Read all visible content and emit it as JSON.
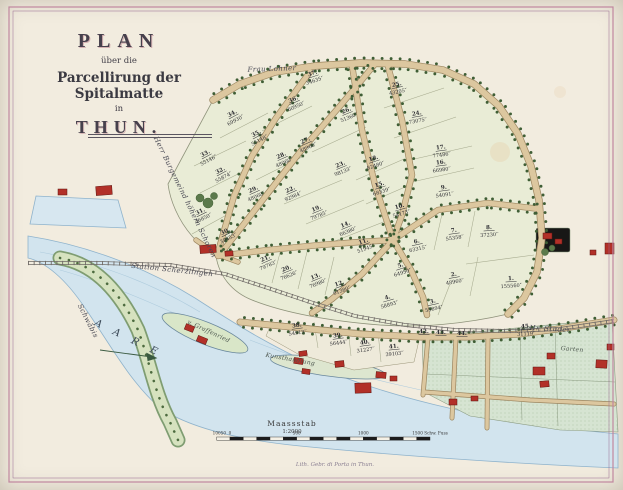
{
  "title": {
    "line1": "PLAN",
    "line2": "über die",
    "line3": "Parcellirung der Spitalmatte",
    "line4": "in",
    "line5": "THUN."
  },
  "labels": [
    {
      "id": "frau-lohner",
      "text": "Frau Lohner",
      "x": 272,
      "y": 71,
      "rot": -2,
      "cls": "cursive"
    },
    {
      "id": "owner-schoren",
      "text": "Herr Burgemeind höhern Schoren",
      "x": 183,
      "y": 198,
      "rot": 64,
      "cls": "cursive"
    },
    {
      "id": "station-scherzlingen",
      "text": "Station Scherzlingen",
      "x": 172,
      "y": 272,
      "rot": 6,
      "cls": "cursive"
    },
    {
      "id": "river-aare",
      "text": "A A R E",
      "x": 127,
      "y": 341,
      "rot": 26,
      "cls": "river"
    },
    {
      "id": "schwaebis",
      "text": "Schwäbis",
      "x": 86,
      "y": 322,
      "rot": 63,
      "cls": "cursive"
    },
    {
      "id": "graffenried",
      "text": "v. Graffenried",
      "x": 208,
      "y": 333,
      "rot": 25,
      "cls": "cursive-sm"
    },
    {
      "id": "kunsthandlung",
      "text": "Kunsthandlung",
      "x": 290,
      "y": 361,
      "rot": 10,
      "cls": "cursive-sm"
    },
    {
      "id": "hr-studer",
      "text": "Hr. Studer",
      "x": 550,
      "y": 331,
      "rot": 3,
      "cls": "cursive"
    },
    {
      "id": "garten",
      "text": "Garten",
      "x": 572,
      "y": 351,
      "rot": 5,
      "cls": "cursive-sm"
    }
  ],
  "area_suffix": "°′",
  "parcels": [
    {
      "n": "1.",
      "a": "155560",
      "x": 511,
      "y": 280,
      "r": -4
    },
    {
      "n": "2.",
      "a": "48960",
      "x": 454,
      "y": 276,
      "r": -10
    },
    {
      "n": "3.",
      "a": "55894",
      "x": 433,
      "y": 303,
      "r": -12
    },
    {
      "n": "4.",
      "a": "58893",
      "x": 388,
      "y": 299,
      "r": -16
    },
    {
      "n": "5.",
      "a": "64950",
      "x": 401,
      "y": 267,
      "r": -18
    },
    {
      "n": "6.",
      "a": "63315",
      "x": 417,
      "y": 243,
      "r": -12
    },
    {
      "n": "7.",
      "a": "55358",
      "x": 454,
      "y": 232,
      "r": -8
    },
    {
      "n": "8.",
      "a": "37230",
      "x": 489,
      "y": 229,
      "r": -4
    },
    {
      "n": "9.",
      "a": "54091",
      "x": 444,
      "y": 189,
      "r": -8
    },
    {
      "n": "10.",
      "a": "54173",
      "x": 400,
      "y": 208,
      "r": -16
    },
    {
      "n": "11.",
      "a": "51945",
      "x": 364,
      "y": 243,
      "r": -20
    },
    {
      "n": "12.",
      "a": "61380",
      "x": 340,
      "y": 285,
      "r": -20
    },
    {
      "n": "13.",
      "a": "76980",
      "x": 316,
      "y": 278,
      "r": -22
    },
    {
      "n": "14.",
      "a": "66380",
      "x": 346,
      "y": 226,
      "r": -22
    },
    {
      "n": "15.",
      "a": "68339",
      "x": 380,
      "y": 186,
      "r": -18
    },
    {
      "n": "16.",
      "a": "66980",
      "x": 441,
      "y": 164,
      "r": -8
    },
    {
      "n": "17.",
      "a": "77486",
      "x": 441,
      "y": 149,
      "r": -8
    },
    {
      "n": "18.",
      "a": "82480",
      "x": 374,
      "y": 160,
      "r": -18
    },
    {
      "n": "19.",
      "a": "79785",
      "x": 317,
      "y": 210,
      "r": -22
    },
    {
      "n": "20.",
      "a": "76626",
      "x": 287,
      "y": 270,
      "r": -22
    },
    {
      "n": "21.",
      "a": "79783",
      "x": 266,
      "y": 260,
      "r": -24
    },
    {
      "n": "22.",
      "a": "92984",
      "x": 291,
      "y": 191,
      "r": -24
    },
    {
      "n": "23.",
      "a": "98133",
      "x": 341,
      "y": 166,
      "r": -22
    },
    {
      "n": "24.",
      "a": "73075",
      "x": 417,
      "y": 115,
      "r": -10
    },
    {
      "n": "25.",
      "a": "43205",
      "x": 397,
      "y": 86,
      "r": -12
    },
    {
      "n": "26.",
      "a": "51360",
      "x": 347,
      "y": 112,
      "r": -22
    },
    {
      "n": "27.",
      "a": "48960",
      "x": 306,
      "y": 142,
      "r": -24
    },
    {
      "n": "28.",
      "a": "48060",
      "x": 282,
      "y": 157,
      "r": -24
    },
    {
      "n": "29.",
      "a": "48060",
      "x": 254,
      "y": 191,
      "r": -24
    },
    {
      "n": "30.",
      "a": "39453",
      "x": 226,
      "y": 233,
      "r": -26
    },
    {
      "n": "31.",
      "a": "46850",
      "x": 201,
      "y": 213,
      "r": -26
    },
    {
      "n": "32.",
      "a": "55874",
      "x": 221,
      "y": 172,
      "r": -28
    },
    {
      "n": "33.",
      "a": "55146",
      "x": 206,
      "y": 155,
      "r": -28
    },
    {
      "n": "34.",
      "a": "69930",
      "x": 233,
      "y": 115,
      "r": -28
    },
    {
      "n": "35.",
      "a": "55148",
      "x": 257,
      "y": 135,
      "r": -28
    },
    {
      "n": "36.",
      "a": "60950",
      "x": 294,
      "y": 101,
      "r": -24
    },
    {
      "n": "37.",
      "a": "34635",
      "x": 313,
      "y": 75,
      "r": -18
    },
    {
      "n": "38.",
      "a": "54913",
      "x": 297,
      "y": 327,
      "r": -8
    },
    {
      "n": "39.",
      "a": "56444",
      "x": 338,
      "y": 337,
      "r": -8
    },
    {
      "n": "40.",
      "a": "31227",
      "x": 365,
      "y": 344,
      "r": -8
    },
    {
      "n": "41.",
      "a": "39103",
      "x": 394,
      "y": 348,
      "r": -6
    },
    {
      "n": "42.",
      "a": "",
      "x": 424,
      "y": 333,
      "r": 0
    },
    {
      "n": "43.",
      "a": "",
      "x": 441,
      "y": 334,
      "r": 0
    },
    {
      "n": "44.",
      "a": "",
      "x": 462,
      "y": 335,
      "r": 0
    },
    {
      "n": "45.",
      "a": "31119",
      "x": 526,
      "y": 328,
      "r": -3
    }
  ],
  "scale": {
    "caption": "Maassstab",
    "ratio": "1:2000",
    "ticks": [
      {
        "v": -100,
        "t": "100"
      },
      {
        "v": -50,
        "t": "50"
      },
      {
        "v": 0,
        "t": "0"
      },
      {
        "v": 500,
        "t": "500"
      },
      {
        "v": 1000,
        "t": "1000"
      },
      {
        "v": 1500,
        "t": "1500 Schw. Fuss"
      }
    ]
  },
  "imprint": "Lith. Gebr. di Porta in Thun.",
  "colors": {
    "paper": "#f2ecdf",
    "field": "#e9ecd6",
    "road_fill": "#dcc79f",
    "road_edge": "#9c8660",
    "water": "#d2e4ee",
    "water_edge": "#8fb3cc",
    "building": "#b23028",
    "building_edge": "#5f1510",
    "tree": "#3f5e35",
    "divider": "#a6aa8e",
    "rail": "#6f6a66",
    "frame": "#b87f9e"
  }
}
